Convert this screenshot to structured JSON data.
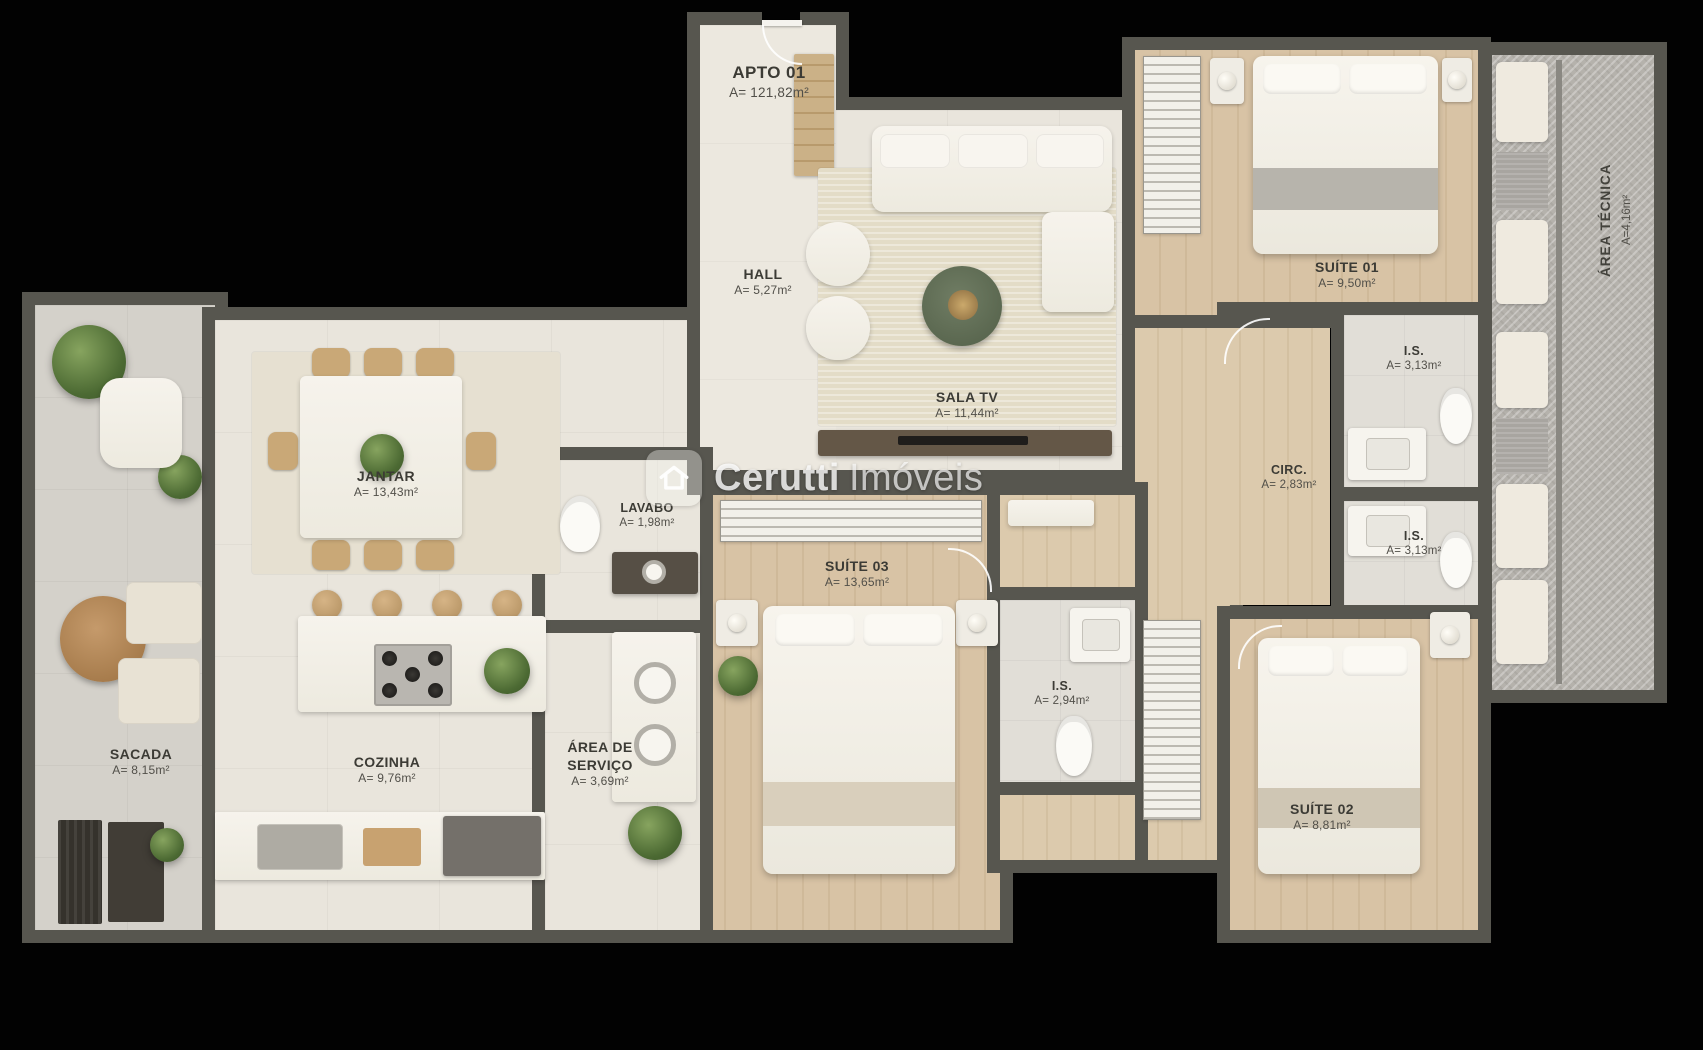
{
  "watermark": {
    "brand_bold": "Cerutti",
    "brand_light": "Imóveis"
  },
  "rooms": {
    "apto": {
      "name": "APTO 01",
      "area": "A= 121,82m²"
    },
    "hall": {
      "name": "HALL",
      "area": "A= 5,27m²"
    },
    "sala_tv": {
      "name": "SALA TV",
      "area": "A= 11,44m²"
    },
    "suite01": {
      "name": "SUÍTE 01",
      "area": "A= 9,50m²"
    },
    "area_tecnica": {
      "name": "ÁREA TÉCNICA",
      "area": "A=4,16m²"
    },
    "is_top": {
      "name": "I.S.",
      "area": "A= 3,13m²"
    },
    "is_mid": {
      "name": "I.S.",
      "area": "A= 3,13m²"
    },
    "circ": {
      "name": "CIRC.",
      "area": "A= 2,83m²"
    },
    "lavabo": {
      "name": "LAVABO",
      "area": "A= 1,98m²"
    },
    "jantar": {
      "name": "JANTAR",
      "area": "A= 13,43m²"
    },
    "sacada": {
      "name": "SACADA",
      "area": "A= 8,15m²"
    },
    "cozinha": {
      "name": "COZINHA",
      "area": "A= 9,76m²"
    },
    "area_servico": {
      "name": "ÁREA DE SERVIÇO",
      "area": "A= 3,69m²"
    },
    "suite03": {
      "name": "SUÍTE 03",
      "area": "A= 13,65m²"
    },
    "is_suite03": {
      "name": "I.S.",
      "area": "A= 2,94m²"
    },
    "suite02": {
      "name": "SUÍTE 02",
      "area": "A= 8,81m²"
    }
  },
  "colors": {
    "wall": "#57564f",
    "wood": "#d5c0a0",
    "floor": "#e9e5dc",
    "background": "#020202"
  }
}
